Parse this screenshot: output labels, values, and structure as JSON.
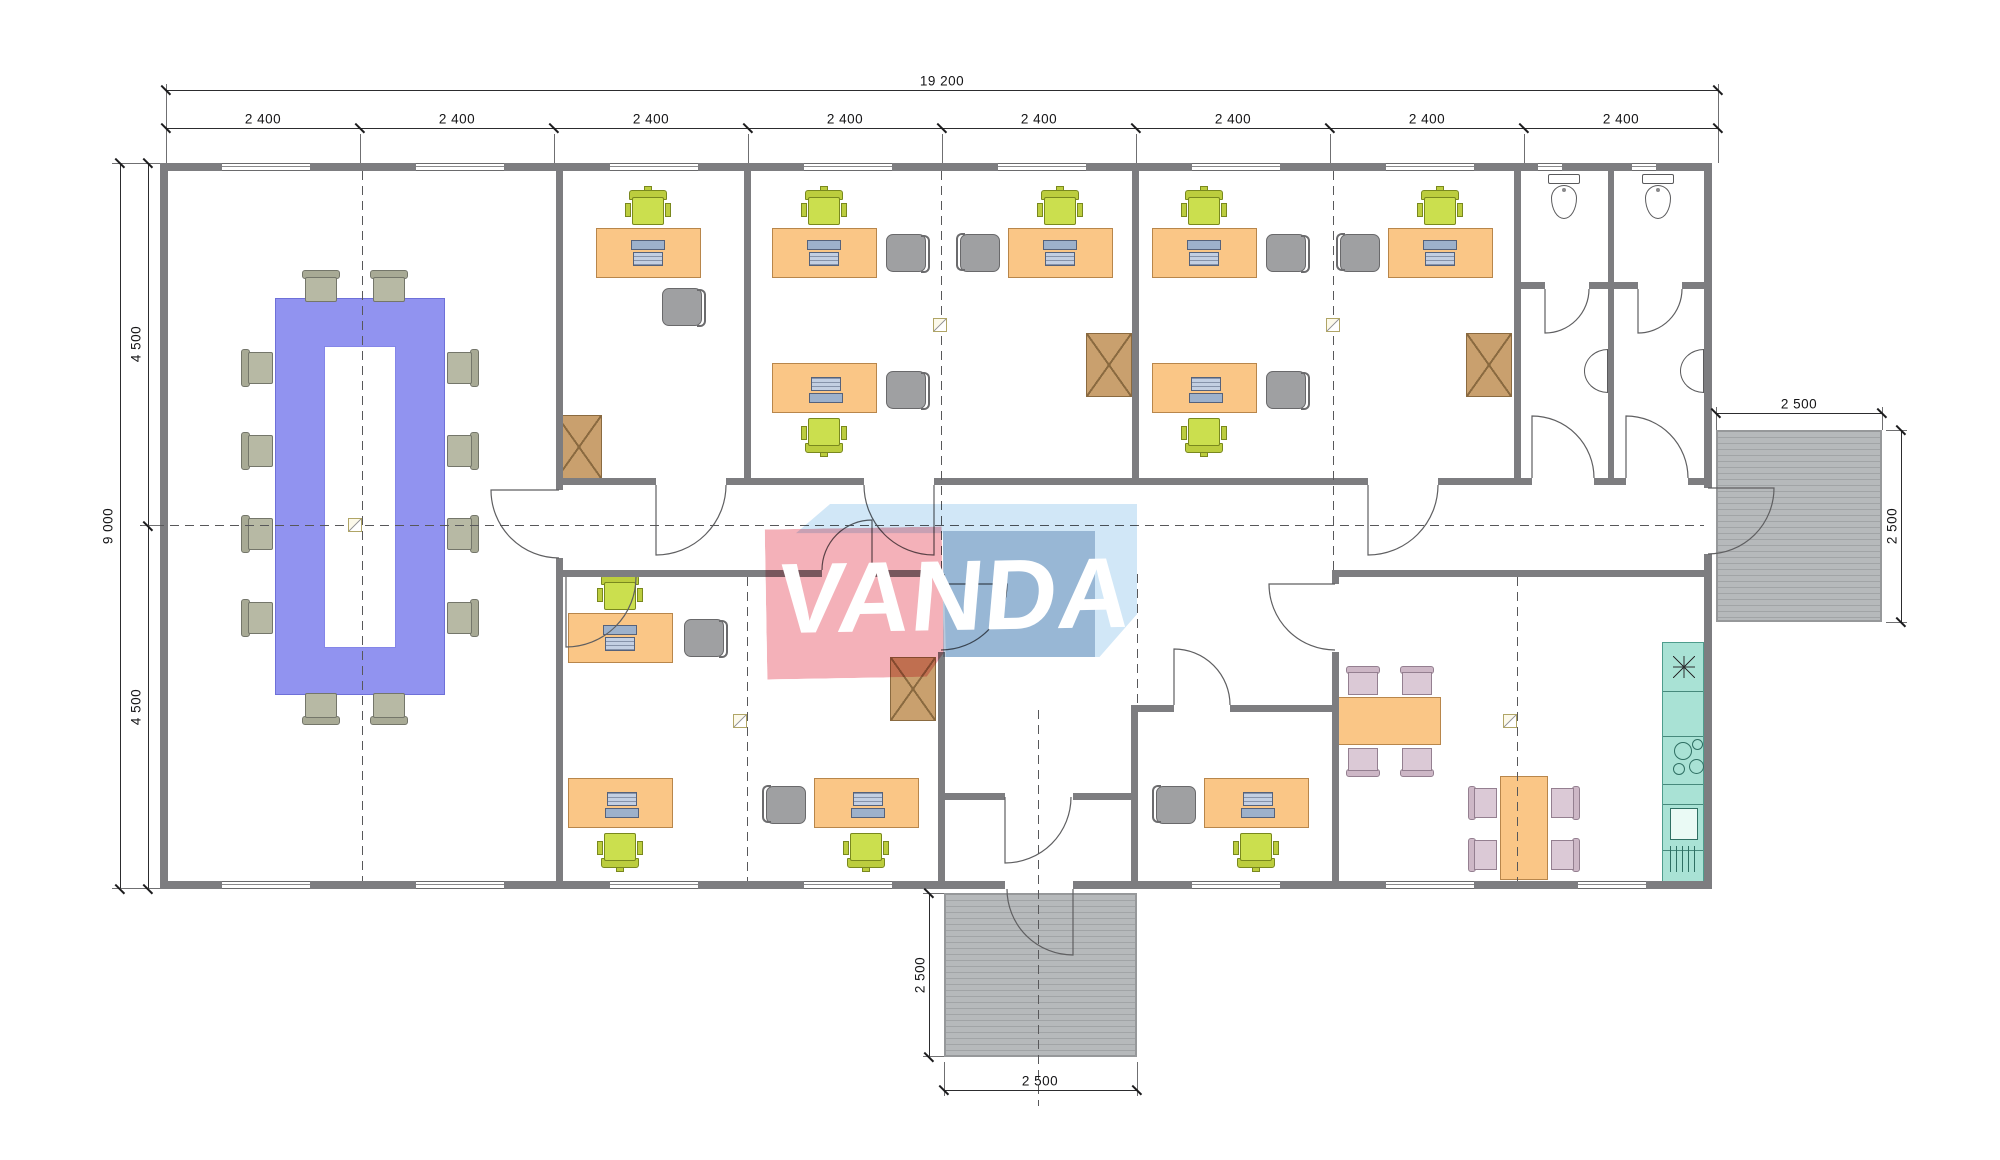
{
  "watermark": {
    "text": "VANDA",
    "red": "#f4adb5",
    "sky_blue": "#cfe6f7",
    "steel_blue": "#b7c7da"
  },
  "dims": {
    "top_total": "19 200",
    "top_segments": [
      "2 400",
      "2 400",
      "2 400",
      "2 400",
      "2 400",
      "2 400",
      "2 400",
      "2 400"
    ],
    "left_total": "9 000",
    "left_segments": [
      "4 500",
      "4 500"
    ],
    "right_porch_w": "2 500",
    "right_porch_h": "2 500",
    "bottom_porch_w": "2 500",
    "bottom_porch_h": "2 500"
  },
  "colors": {
    "wall": "#7d7d80",
    "desk": "#FAC686",
    "desk_border": "#B8864B",
    "task_chair": "#cbdf4e",
    "office_chair": "#9fa0a2",
    "meeting_chair": "#b7b9a4",
    "dining_chair": "#dbc9d6",
    "conference_table": "#9193F0",
    "cabinet": "#C9A06E",
    "kitchen_counter": "#A9E2D5",
    "porch": "#b6b9bb"
  },
  "plan": {
    "walls": [
      [
        160,
        163,
        1552,
        8
      ],
      [
        160,
        881,
        845,
        8
      ],
      [
        1073,
        881,
        639,
        8
      ],
      [
        160,
        163,
        8,
        726
      ],
      [
        1704,
        163,
        8,
        325
      ],
      [
        1704,
        554,
        8,
        335
      ],
      [
        556,
        171,
        7,
        319
      ],
      [
        556,
        558,
        7,
        323
      ],
      [
        744,
        171,
        7,
        307
      ],
      [
        1132,
        171,
        7,
        307
      ],
      [
        1514,
        171,
        7,
        307
      ],
      [
        1608,
        171,
        6,
        307
      ],
      [
        938,
        574,
        7,
        10
      ],
      [
        938,
        652,
        7,
        229
      ],
      [
        1131,
        705,
        7,
        176
      ],
      [
        1332,
        570,
        7,
        14
      ],
      [
        1332,
        652,
        7,
        229
      ],
      [
        556,
        478,
        100,
        7
      ],
      [
        726,
        478,
        138,
        7
      ],
      [
        934,
        478,
        434,
        7
      ],
      [
        1438,
        478,
        94,
        7
      ],
      [
        1594,
        478,
        32,
        7
      ],
      [
        1688,
        478,
        16,
        7
      ],
      [
        563,
        570,
        259,
        7
      ],
      [
        872,
        570,
        66,
        7
      ],
      [
        1339,
        570,
        365,
        7
      ],
      [
        1138,
        705,
        36,
        7
      ],
      [
        1230,
        705,
        102,
        7
      ],
      [
        1521,
        282,
        24,
        7
      ],
      [
        1589,
        282,
        19,
        7
      ],
      [
        1614,
        282,
        24,
        7
      ],
      [
        1682,
        282,
        22,
        7
      ],
      [
        945,
        793,
        60,
        7
      ],
      [
        1073,
        793,
        58,
        7
      ]
    ],
    "windows_top": [
      [
        222,
        88
      ],
      [
        416,
        88
      ],
      [
        610,
        88
      ],
      [
        804,
        88
      ],
      [
        998,
        88
      ],
      [
        1192,
        88
      ],
      [
        1386,
        88
      ],
      [
        1538,
        24
      ],
      [
        1632,
        24
      ]
    ],
    "windows_bottom": [
      [
        222,
        88
      ],
      [
        416,
        88
      ],
      [
        610,
        88
      ],
      [
        804,
        88
      ],
      [
        1192,
        88
      ],
      [
        1386,
        88
      ],
      [
        1578,
        68
      ]
    ],
    "axes_h": [
      [
        140,
        525,
        1704
      ]
    ],
    "axes_v": [
      [
        362,
        171,
        881
      ],
      [
        941,
        171,
        570
      ],
      [
        1333,
        171,
        570
      ],
      [
        747,
        577,
        881
      ],
      [
        1517,
        577,
        881
      ],
      [
        1137,
        574,
        705
      ],
      [
        1038,
        710,
        1106
      ]
    ],
    "porches": {
      "right": [
        1716,
        430,
        166,
        192
      ],
      "bottom": [
        944,
        893,
        193,
        164
      ]
    },
    "doors": [
      [
        559,
        490,
        68,
        90,
        180
      ],
      [
        656,
        485,
        70,
        0,
        90
      ],
      [
        934,
        485,
        70,
        180,
        90
      ],
      [
        1368,
        485,
        70,
        0,
        90
      ],
      [
        1532,
        478,
        62,
        0,
        270
      ],
      [
        1626,
        478,
        62,
        0,
        270
      ],
      [
        1545,
        289,
        44,
        0,
        90
      ],
      [
        1638,
        289,
        44,
        0,
        90
      ],
      [
        872,
        570,
        50,
        180,
        270
      ],
      [
        566,
        577,
        70,
        0,
        90
      ],
      [
        941,
        584,
        66,
        90,
        0
      ],
      [
        1174,
        705,
        56,
        0,
        270
      ],
      [
        1335,
        584,
        66,
        90,
        180
      ],
      [
        1005,
        797,
        66,
        0,
        90
      ],
      [
        1073,
        889,
        66,
        180,
        90
      ],
      [
        1708,
        488,
        66,
        90,
        0
      ]
    ],
    "markers": [
      [
        348,
        518
      ],
      [
        933,
        318
      ],
      [
        1326,
        318
      ],
      [
        733,
        714
      ],
      [
        1503,
        714
      ]
    ],
    "furniture": [
      {
        "t": "conference-table",
        "x": 275,
        "y": 298,
        "w": 170,
        "h": 397,
        "hole": [
          48,
          47,
          72,
          302
        ]
      },
      {
        "t": "meeting-chair",
        "x": 300,
        "y": 270,
        "w": 42,
        "h": 32,
        "r": 0
      },
      {
        "t": "meeting-chair",
        "x": 368,
        "y": 270,
        "w": 42,
        "h": 32,
        "r": 0
      },
      {
        "t": "meeting-chair",
        "x": 300,
        "y": 693,
        "w": 42,
        "h": 32,
        "r": 180
      },
      {
        "t": "meeting-chair",
        "x": 368,
        "y": 693,
        "w": 42,
        "h": 32,
        "r": 180
      },
      {
        "t": "meeting-chair",
        "x": 241,
        "y": 347,
        "w": 34,
        "h": 42,
        "r": 270
      },
      {
        "t": "meeting-chair",
        "x": 241,
        "y": 430,
        "w": 34,
        "h": 42,
        "r": 270
      },
      {
        "t": "meeting-chair",
        "x": 241,
        "y": 513,
        "w": 34,
        "h": 42,
        "r": 270
      },
      {
        "t": "meeting-chair",
        "x": 241,
        "y": 597,
        "w": 34,
        "h": 42,
        "r": 270
      },
      {
        "t": "meeting-chair",
        "x": 445,
        "y": 347,
        "w": 34,
        "h": 42,
        "r": 90
      },
      {
        "t": "meeting-chair",
        "x": 445,
        "y": 430,
        "w": 34,
        "h": 42,
        "r": 90
      },
      {
        "t": "meeting-chair",
        "x": 445,
        "y": 513,
        "w": 34,
        "h": 42,
        "r": 90
      },
      {
        "t": "meeting-chair",
        "x": 445,
        "y": 597,
        "w": 34,
        "h": 42,
        "r": 90
      },
      {
        "t": "desk",
        "x": 596,
        "y": 228,
        "r": 0
      },
      {
        "t": "desk",
        "x": 772,
        "y": 228,
        "r": 0
      },
      {
        "t": "desk",
        "x": 772,
        "y": 363,
        "r": 180
      },
      {
        "t": "desk",
        "x": 1008,
        "y": 228,
        "r": 0
      },
      {
        "t": "desk",
        "x": 1152,
        "y": 228,
        "r": 0
      },
      {
        "t": "desk",
        "x": 1152,
        "y": 363,
        "r": 180
      },
      {
        "t": "desk",
        "x": 1388,
        "y": 228,
        "r": 0
      },
      {
        "t": "desk",
        "x": 568,
        "y": 613,
        "r": 0
      },
      {
        "t": "desk",
        "x": 568,
        "y": 778,
        "r": 180
      },
      {
        "t": "desk",
        "x": 814,
        "y": 778,
        "r": 180
      },
      {
        "t": "desk",
        "x": 1204,
        "y": 778,
        "r": 180
      },
      {
        "t": "task-chair",
        "x": 625,
        "y": 190,
        "r": 0
      },
      {
        "t": "task-chair",
        "x": 801,
        "y": 190,
        "r": 0
      },
      {
        "t": "task-chair",
        "x": 801,
        "y": 415,
        "r": 180
      },
      {
        "t": "task-chair",
        "x": 1037,
        "y": 190,
        "r": 0
      },
      {
        "t": "task-chair",
        "x": 1181,
        "y": 190,
        "r": 0
      },
      {
        "t": "task-chair",
        "x": 1181,
        "y": 415,
        "r": 180
      },
      {
        "t": "task-chair",
        "x": 1417,
        "y": 190,
        "r": 0
      },
      {
        "t": "task-chair",
        "x": 597,
        "y": 575,
        "r": 0
      },
      {
        "t": "task-chair",
        "x": 597,
        "y": 830,
        "r": 180
      },
      {
        "t": "task-chair",
        "x": 843,
        "y": 830,
        "r": 180
      },
      {
        "t": "task-chair",
        "x": 1233,
        "y": 830,
        "r": 180
      },
      {
        "t": "office-chair",
        "x": 660,
        "y": 286,
        "r": 90
      },
      {
        "t": "office-chair",
        "x": 884,
        "y": 232,
        "r": 90
      },
      {
        "t": "office-chair",
        "x": 884,
        "y": 369,
        "r": 90
      },
      {
        "t": "office-chair",
        "x": 958,
        "y": 232,
        "r": 270
      },
      {
        "t": "office-chair",
        "x": 1264,
        "y": 232,
        "r": 90
      },
      {
        "t": "office-chair",
        "x": 1264,
        "y": 369,
        "r": 90
      },
      {
        "t": "office-chair",
        "x": 1338,
        "y": 232,
        "r": 270
      },
      {
        "t": "office-chair",
        "x": 682,
        "y": 617,
        "r": 90
      },
      {
        "t": "office-chair",
        "x": 764,
        "y": 784,
        "r": 270
      },
      {
        "t": "office-chair",
        "x": 1154,
        "y": 784,
        "r": 270
      },
      {
        "t": "storage-cabinet",
        "x": 556,
        "y": 415,
        "w": 46,
        "h": 64
      },
      {
        "t": "storage-cabinet",
        "x": 1086,
        "y": 333,
        "w": 46,
        "h": 64
      },
      {
        "t": "storage-cabinet",
        "x": 1466,
        "y": 333,
        "w": 46,
        "h": 64
      },
      {
        "t": "storage-cabinet",
        "x": 890,
        "y": 657,
        "w": 46,
        "h": 64
      },
      {
        "t": "dining-table",
        "x": 1337,
        "y": 697,
        "w": 104,
        "h": 48
      },
      {
        "t": "dining-table",
        "x": 1500,
        "y": 776,
        "w": 48,
        "h": 104
      },
      {
        "t": "dining-chair",
        "x": 1344,
        "y": 666,
        "w": 38,
        "h": 30,
        "r": 0
      },
      {
        "t": "dining-chair",
        "x": 1398,
        "y": 666,
        "w": 38,
        "h": 30,
        "r": 0
      },
      {
        "t": "dining-chair",
        "x": 1344,
        "y": 747,
        "w": 38,
        "h": 30,
        "r": 180
      },
      {
        "t": "dining-chair",
        "x": 1398,
        "y": 747,
        "w": 38,
        "h": 30,
        "r": 180
      },
      {
        "t": "dining-chair",
        "x": 1468,
        "y": 784,
        "w": 30,
        "h": 38,
        "r": 270
      },
      {
        "t": "dining-chair",
        "x": 1468,
        "y": 836,
        "w": 30,
        "h": 38,
        "r": 270
      },
      {
        "t": "dining-chair",
        "x": 1550,
        "y": 784,
        "w": 30,
        "h": 38,
        "r": 90
      },
      {
        "t": "dining-chair",
        "x": 1550,
        "y": 836,
        "w": 30,
        "h": 38,
        "r": 90
      },
      {
        "t": "kitchen-counter",
        "x": 1662,
        "y": 642,
        "w": 42,
        "h": 240
      },
      {
        "t": "toilet",
        "x": 1548,
        "y": 174
      },
      {
        "t": "toilet",
        "x": 1642,
        "y": 174
      },
      {
        "t": "sink",
        "x": 1584,
        "y": 349
      },
      {
        "t": "sink",
        "x": 1680,
        "y": 349
      }
    ]
  }
}
